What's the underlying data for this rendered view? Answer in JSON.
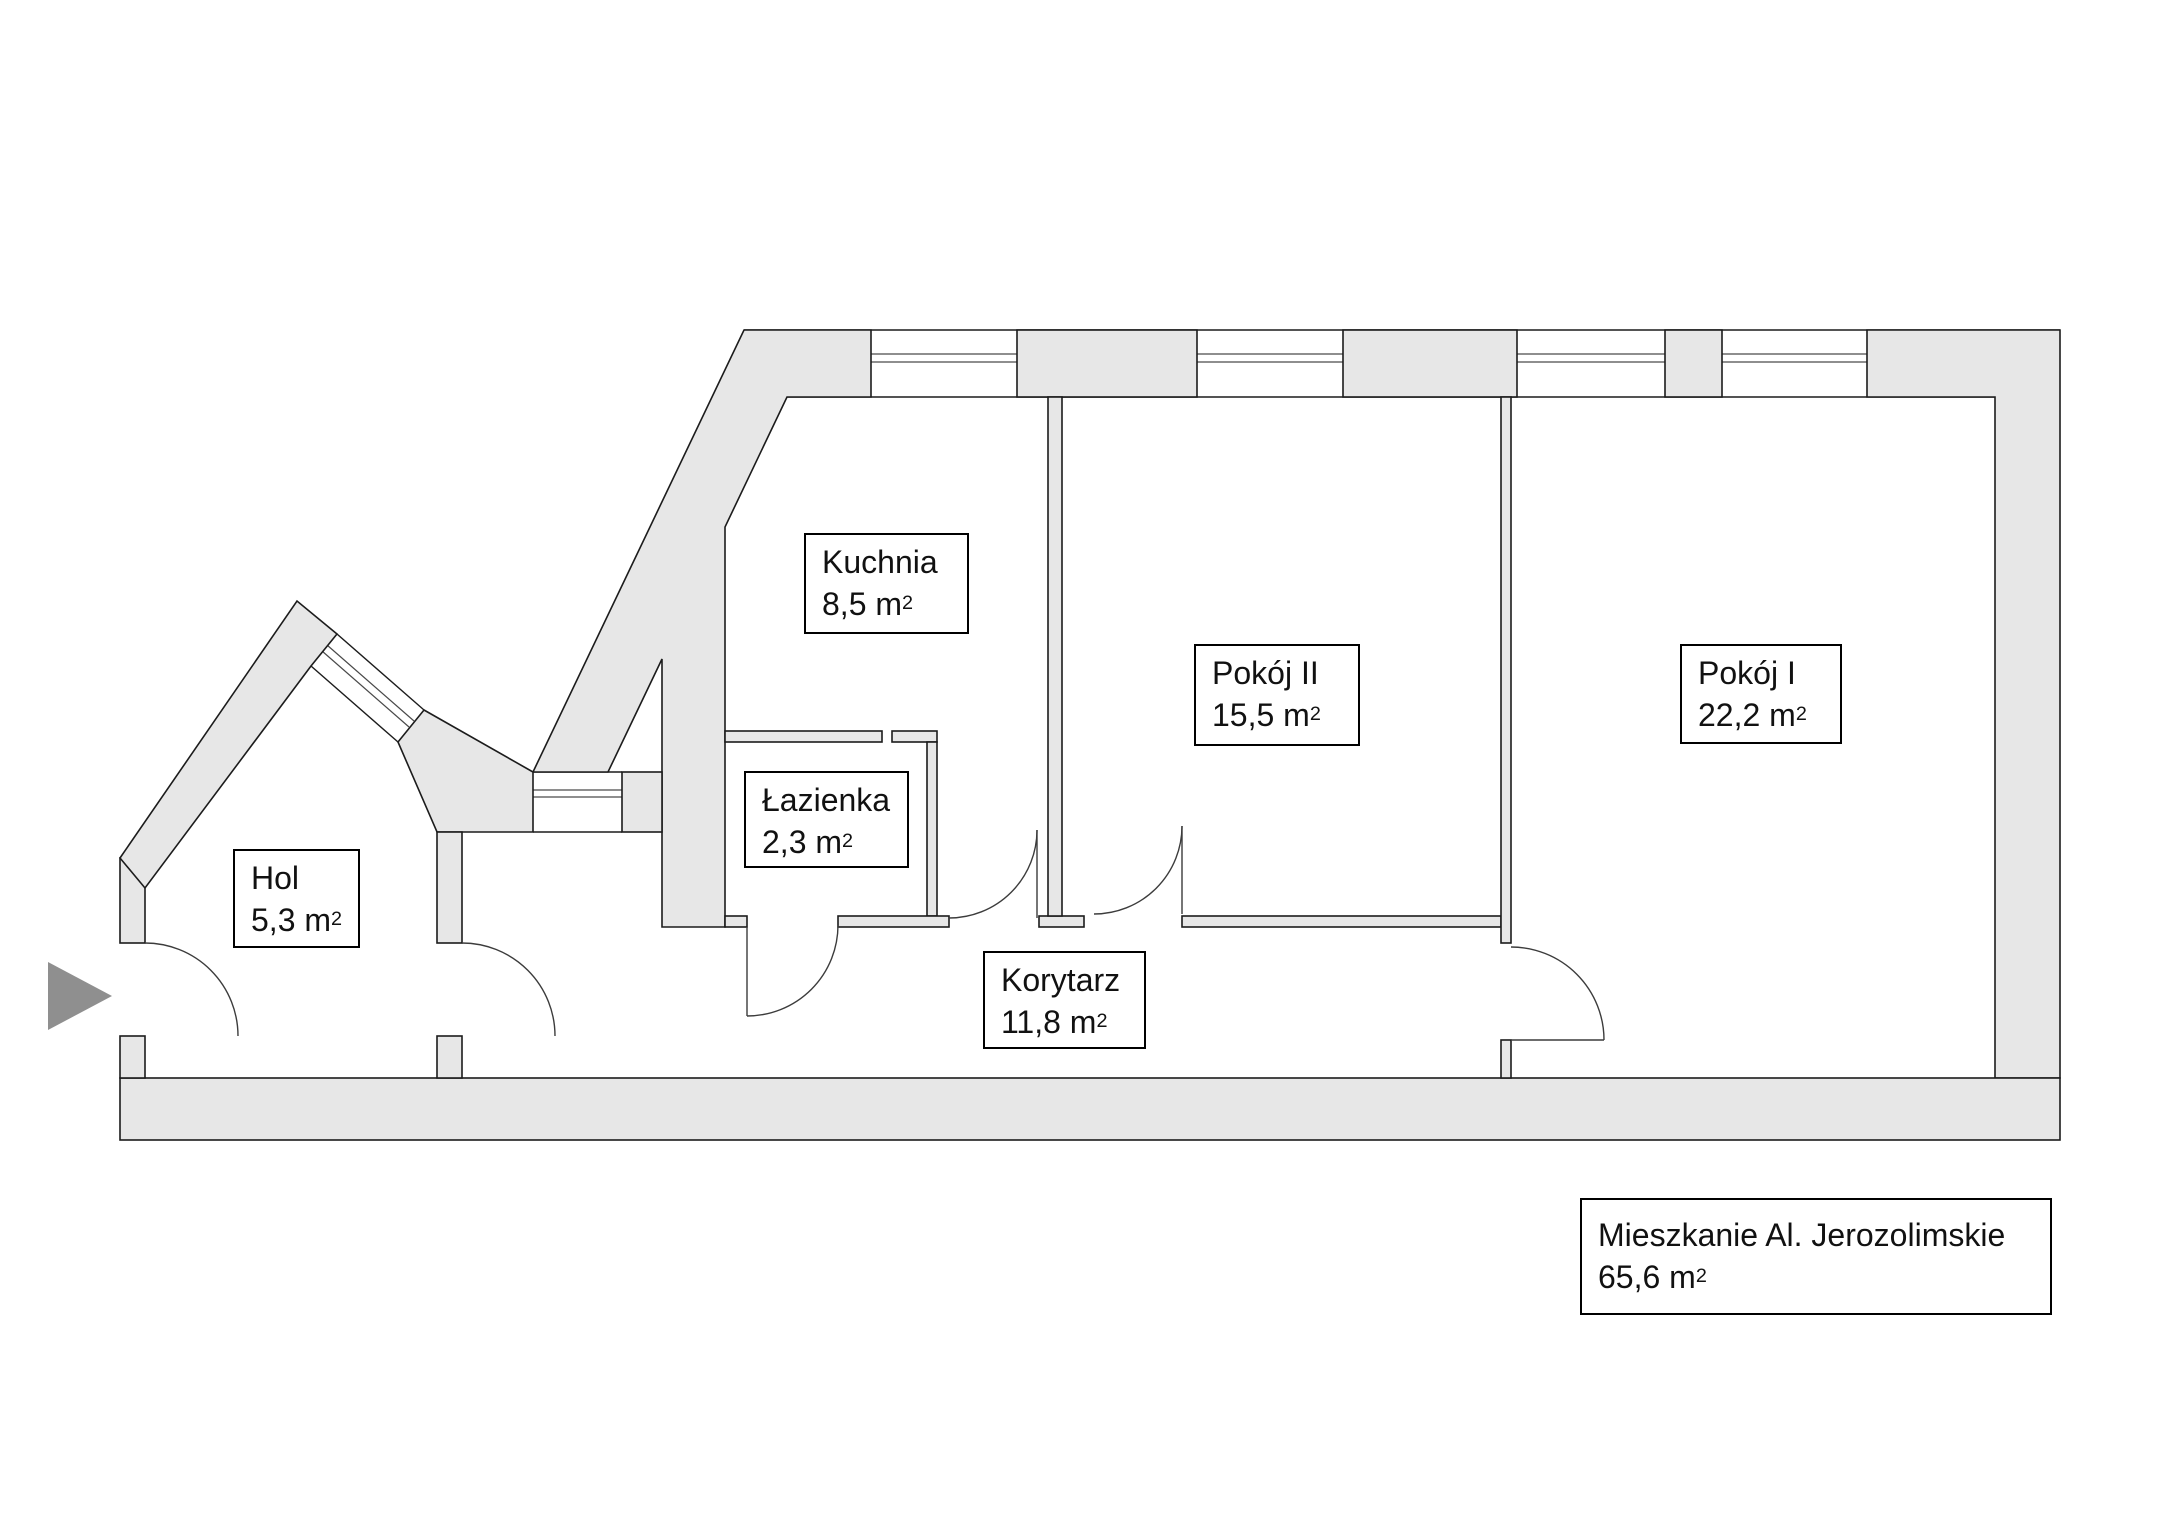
{
  "floorplan": {
    "title": {
      "name": "Mieszkanie Al. Jerozolimskie",
      "area_m": "65,6 m",
      "sup": "2"
    },
    "rooms": [
      {
        "id": "kuchnia",
        "name": "Kuchnia",
        "area_m": "8,5 m",
        "sup": "2"
      },
      {
        "id": "pokoj-ii",
        "name": "Pokój II",
        "area_m": "15,5 m",
        "sup": "2"
      },
      {
        "id": "pokoj-i",
        "name": "Pokój I",
        "area_m": "22,2 m",
        "sup": "2"
      },
      {
        "id": "lazienka",
        "name": "Łazienka",
        "area_m": "2,3 m",
        "sup": "2"
      },
      {
        "id": "hol",
        "name": "Hol",
        "area_m": "5,3 m",
        "sup": "2"
      },
      {
        "id": "korytarz",
        "name": "Korytarz",
        "area_m": "11,8 m",
        "sup": "2"
      }
    ],
    "colors": {
      "background": "#ffffff",
      "wall_fill": "#e7e7e7",
      "wall_outline": "#1c1c1c",
      "door_line": "#3c3c3c",
      "arrow": "#8f8f8f"
    }
  }
}
